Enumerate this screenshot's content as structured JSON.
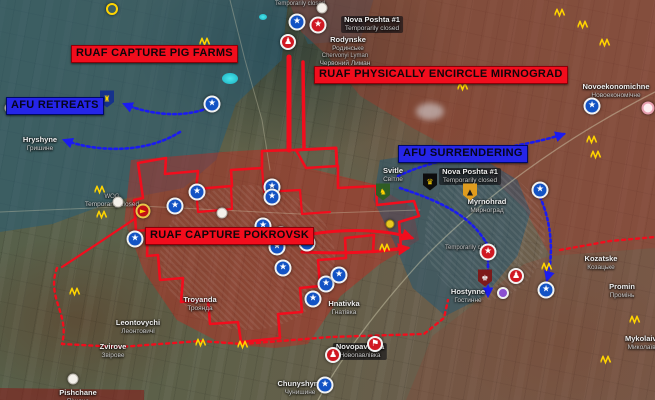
{
  "map": {
    "colors": {
      "ruaf_banner": "#f20d1d",
      "afu_banner": "#2525e8",
      "front_line_red": "#f20d1d",
      "afu_arrow_blue": "#1b1bf0",
      "fortification_yellow": "#ffd400"
    },
    "banners": [
      {
        "id": "pig-farms",
        "text": "RUAF CAPTURE PIG FARMS",
        "type": "ruaf",
        "x": 71,
        "y": 45
      },
      {
        "id": "encircle-mirnograd",
        "text": "RUAF PHYSICALLY ENCIRCLE MIRNOGRAD",
        "type": "ruaf",
        "x": 314,
        "y": 66
      },
      {
        "id": "capture-pokrovsk",
        "text": "RUAF CAPTURE POKROVSK",
        "type": "ruaf",
        "x": 145,
        "y": 227
      },
      {
        "id": "afu-retreats",
        "text": "AFU RETREATS",
        "type": "afu",
        "x": 6,
        "y": 97
      },
      {
        "id": "afu-surrendering",
        "text": "AFU SURRENDERING",
        "type": "afu",
        "x": 398,
        "y": 145
      }
    ],
    "towns": [
      {
        "name": "Hryshyne",
        "sub": "Гришине",
        "x": 40,
        "y": 136
      },
      {
        "name": "Rodynske",
        "sub": "Родинське",
        "x": 348,
        "y": 36
      },
      {
        "name": "Nova Poshta #1",
        "sub": "Temporarily closed",
        "x": 372,
        "y": 16,
        "variant": "chip"
      },
      {
        "name": "Temporarily closed",
        "x": 300,
        "y": 1,
        "variant": "tiny"
      },
      {
        "name": "Chervonyi Lyman",
        "sub": "Червоний Лиман",
        "x": 345,
        "y": 53,
        "variant": "tiny"
      },
      {
        "name": "Novoekonomichne",
        "sub": "Новоекономічне",
        "x": 616,
        "y": 83
      },
      {
        "name": "Svitle",
        "sub": "Світле",
        "x": 393,
        "y": 167
      },
      {
        "name": "Myrnohrad",
        "sub": "Мирноград",
        "x": 487,
        "y": 198
      },
      {
        "name": "Nova Poshta #1",
        "sub": "Temporarily closed",
        "x": 470,
        "y": 168,
        "variant": "chip"
      },
      {
        "name": "Hnativka",
        "sub": "Гнатівка",
        "x": 344,
        "y": 300
      },
      {
        "name": "Temporarily closed",
        "x": 470,
        "y": 245,
        "variant": "tiny"
      },
      {
        "name": "Hostynne",
        "sub": "Гостинне",
        "x": 468,
        "y": 288
      },
      {
        "name": "Troyanda",
        "sub": "Троянда",
        "x": 200,
        "y": 296
      },
      {
        "name": "Leontovychi",
        "sub": "Леонтовичі",
        "x": 138,
        "y": 319
      },
      {
        "name": "Zvirove",
        "sub": "Звірове",
        "x": 113,
        "y": 343
      },
      {
        "name": "Pishchane",
        "sub": "Піщане",
        "x": 78,
        "y": 389
      },
      {
        "name": "Kozatske",
        "sub": "Козацьке",
        "x": 601,
        "y": 255
      },
      {
        "name": "Promin",
        "sub": "Промінь",
        "x": 622,
        "y": 283
      },
      {
        "name": "Mykolaivka",
        "sub": "Миколаївка",
        "x": 645,
        "y": 335
      },
      {
        "name": "Novopavlivka",
        "sub": "Новопавлівка",
        "x": 360,
        "y": 343,
        "variant": "chip"
      },
      {
        "name": "Chunyshyne",
        "sub": "Чунишине",
        "x": 300,
        "y": 380
      },
      {
        "name": "WOG",
        "sub": "Temporarily closed",
        "x": 112,
        "y": 194,
        "variant": "tiny"
      }
    ],
    "marker_styles": {
      "star-blue": {
        "w": 17,
        "glyph": "★",
        "bg": "#1353c4",
        "fg": "#ffffff",
        "bd": "2px solid #f2f2f2",
        "fs": 9
      },
      "star-red": {
        "w": 17,
        "glyph": "★",
        "bg": "#d01822",
        "fg": "#ffffff",
        "bd": "2px solid #f2f2f2",
        "fs": 9
      },
      "walk-red": {
        "w": 16,
        "glyph": "♟",
        "bg": "#d01822",
        "fg": "#ffffff",
        "bd": "2px solid #f2f2f2",
        "fs": 9
      },
      "flag-red": {
        "w": 16,
        "glyph": "⚑",
        "bg": "#d01822",
        "fg": "#ffffff",
        "bd": "2px solid #f2f2f2",
        "fs": 9
      },
      "hand-red": {
        "w": 15,
        "glyph": "►",
        "bg": "#c01015",
        "fg": "#ffd400",
        "bd": "2px solid #e8c84a",
        "fs": 8
      },
      "closed-white": {
        "w": 11,
        "glyph": "",
        "bg": "#f3f0ea",
        "fg": "#999999",
        "bd": "1px solid #b9b4ac",
        "fs": 6
      },
      "pink-ring": {
        "w": 13,
        "glyph": "",
        "bg": "#fdeef0",
        "fg": "#d06070",
        "bd": "2px solid #e8a0b0",
        "fs": 6
      },
      "purple": {
        "w": 12,
        "glyph": "",
        "bg": "#8a4fd0",
        "fg": "#ffffff",
        "bd": "2px solid #f0f0f0",
        "fs": 6
      },
      "dot-yellow": {
        "w": 9,
        "glyph": "",
        "bg": "#e8c821",
        "fg": "#000000",
        "bd": "1px solid #9a8410",
        "fs": 6
      },
      "ring-yellow": {
        "w": 12,
        "glyph": "",
        "bg": "transparent",
        "fg": "#ffd400",
        "bd": "2px solid #ffd400",
        "fs": 6
      },
      "shield": {
        "w": 14,
        "h": 17,
        "fs": 8,
        "shape": "shield"
      },
      "trench": {
        "w": 11,
        "h": 9,
        "path": "M0,7 L2.5,1 L5,7 L7.5,1 L10,7",
        "stroke": "#ffd400"
      }
    },
    "markers": [
      {
        "type": "star-blue",
        "x": 212,
        "y": 104
      },
      {
        "type": "star-blue",
        "x": 297,
        "y": 22
      },
      {
        "type": "star-blue",
        "x": 135,
        "y": 239
      },
      {
        "type": "star-blue",
        "x": 175,
        "y": 206
      },
      {
        "type": "star-blue",
        "x": 197,
        "y": 192
      },
      {
        "type": "star-blue",
        "x": 263,
        "y": 226
      },
      {
        "type": "star-blue",
        "x": 281,
        "y": 235
      },
      {
        "type": "star-blue",
        "x": 307,
        "y": 243
      },
      {
        "type": "star-blue",
        "x": 277,
        "y": 247
      },
      {
        "type": "star-blue",
        "x": 272,
        "y": 187
      },
      {
        "type": "star-blue",
        "x": 272,
        "y": 197
      },
      {
        "type": "star-blue",
        "x": 283,
        "y": 268
      },
      {
        "type": "star-blue",
        "x": 313,
        "y": 299
      },
      {
        "type": "star-blue",
        "x": 326,
        "y": 284
      },
      {
        "type": "star-blue",
        "x": 339,
        "y": 275
      },
      {
        "type": "star-blue",
        "x": 592,
        "y": 106
      },
      {
        "type": "star-blue",
        "x": 546,
        "y": 290
      },
      {
        "type": "star-blue",
        "x": 540,
        "y": 190
      },
      {
        "type": "star-blue",
        "x": 325,
        "y": 385
      },
      {
        "type": "star-red",
        "x": 318,
        "y": 25
      },
      {
        "type": "star-red",
        "x": 488,
        "y": 252
      },
      {
        "type": "walk-red",
        "x": 288,
        "y": 42
      },
      {
        "type": "walk-red",
        "x": 333,
        "y": 355
      },
      {
        "type": "walk-red",
        "x": 516,
        "y": 276
      },
      {
        "type": "flag-red",
        "x": 375,
        "y": 344
      },
      {
        "type": "hand-red",
        "x": 143,
        "y": 211
      },
      {
        "type": "closed-white",
        "x": 118,
        "y": 202
      },
      {
        "type": "closed-white",
        "x": 322,
        "y": 8
      },
      {
        "type": "closed-white",
        "x": 222,
        "y": 213
      },
      {
        "type": "closed-white",
        "x": 73,
        "y": 379
      },
      {
        "type": "closed-white",
        "x": 10,
        "y": 108
      },
      {
        "type": "pink-ring",
        "x": 648,
        "y": 108
      },
      {
        "type": "purple",
        "x": 503,
        "y": 293
      },
      {
        "type": "dot-yellow",
        "x": 390,
        "y": 224
      },
      {
        "type": "ring-yellow",
        "x": 112,
        "y": 9
      },
      {
        "type": "shield",
        "x": 107,
        "y": 99,
        "bg": "#16328c",
        "glyph": "♜",
        "fg": "#ffd400"
      },
      {
        "type": "shield",
        "x": 430,
        "y": 182,
        "bg": "#0d0d0d",
        "glyph": "♛",
        "fg": "#ffd400"
      },
      {
        "type": "shield",
        "x": 470,
        "y": 192,
        "bg": "#e09c1e",
        "glyph": "▲",
        "fg": "#1a1a1a"
      },
      {
        "type": "shield",
        "x": 383,
        "y": 192,
        "bg": "#2f5d24",
        "glyph": "♞",
        "fg": "#ffd400"
      },
      {
        "type": "shield",
        "x": 485,
        "y": 278,
        "bg": "#7d1a1a",
        "glyph": "♚",
        "fg": "#eeeeee"
      },
      {
        "type": "trench",
        "x": 560,
        "y": 13
      },
      {
        "type": "trench",
        "x": 583,
        "y": 25
      },
      {
        "type": "trench",
        "x": 605,
        "y": 43
      },
      {
        "type": "trench",
        "x": 463,
        "y": 87
      },
      {
        "type": "trench",
        "x": 205,
        "y": 42
      },
      {
        "type": "trench",
        "x": 592,
        "y": 140
      },
      {
        "type": "trench",
        "x": 596,
        "y": 155
      },
      {
        "type": "trench",
        "x": 100,
        "y": 190
      },
      {
        "type": "trench",
        "x": 102,
        "y": 215
      },
      {
        "type": "trench",
        "x": 75,
        "y": 292
      },
      {
        "type": "trench",
        "x": 201,
        "y": 343
      },
      {
        "type": "trench",
        "x": 243,
        "y": 345
      },
      {
        "type": "trench",
        "x": 385,
        "y": 248
      },
      {
        "type": "trench",
        "x": 635,
        "y": 320
      },
      {
        "type": "trench",
        "x": 606,
        "y": 360
      },
      {
        "type": "trench",
        "x": 547,
        "y": 267
      }
    ],
    "lines": [
      {
        "d": "M655,92 C 560,140 480,200 420,262 C 372,315 340,360 318,400",
        "c": "#d8d2b4",
        "w": 1.3,
        "o": 0.45
      },
      {
        "d": "M0,212 L140,206 L300,214 L420,210",
        "c": "#d8d2b4",
        "w": 1,
        "o": 0.35
      },
      {
        "d": "M230,0 L245,60 L262,120 L270,170",
        "c": "#d8d2b4",
        "w": 1,
        "o": 0.35
      },
      {
        "d": "M289,57 L289,150",
        "c": "#f20d1d",
        "w": 5
      },
      {
        "d": "M303,62 L304,148",
        "c": "#f20d1d",
        "w": 3.5
      },
      {
        "d": "M296,150 L336,148 L337,166",
        "c": "#f20d1d",
        "w": 3
      },
      {
        "d": "M138,163 L166,158 L165,174 L198,171 L196,189 L232,186 L231,170 L262,168 L262,151 L296,150 L306,168 L338,166 L338,188 L376,186 L377,205 L414,201 L419,216 L399,222 L401,248 L373,252 L374,235 L345,238 L346,258 L318,260 L320,286 L300,288 L302,312 L278,314 L280,338 L241,342 L238,322 L210,324 L208,300 L181,302 L183,278 L160,280 L158,255 L147,256 L148,230 L136,231 L134,200 L143,198 L138,163",
        "c": "#f20d1d",
        "w": 2.6
      },
      {
        "d": "M196,189 L198,212 L232,209 L231,186",
        "c": "#f20d1d",
        "w": 2.2
      },
      {
        "d": "M262,168 L264,192 L300,190 L302,214 L330,212",
        "c": "#f20d1d",
        "w": 2.2
      },
      {
        "d": "M136,218 L100,242 L62,267",
        "c": "#f20d1d",
        "w": 2.2
      },
      {
        "d": "M312,234 C 350,228 388,230 412,238",
        "c": "#f20d1d",
        "w": 3,
        "arrow": "red"
      },
      {
        "d": "M302,252 C 340,254 378,252 408,248",
        "c": "#f20d1d",
        "w": 3,
        "arrow": "red"
      },
      {
        "d": "M57,268 C 46,298 70,314 62,344 L120,347 L200,341 L243,344 L330,337 L424,334 L444,318 L448,300",
        "c": "#f20d1d",
        "w": 2.4,
        "dash": "3 4"
      },
      {
        "d": "M560,250 L610,241 L655,237",
        "c": "#f20d1d",
        "w": 2.4,
        "dash": "3 4"
      },
      {
        "d": "M208,108 C 178,120 143,112 124,104",
        "c": "#1b1bf0",
        "w": 2.6,
        "dash": "2.5 3",
        "arrow": "blue"
      },
      {
        "d": "M180,132 C 145,154 96,152 64,140",
        "c": "#1b1bf0",
        "w": 2.6,
        "dash": "2.5 3",
        "arrow": "blue"
      },
      {
        "d": "M398,176 C 450,152 515,150 564,134",
        "c": "#1b1bf0",
        "w": 2.6,
        "dash": "2.5 3",
        "arrow": "blue"
      },
      {
        "d": "M400,188 C 442,202 472,216 488,246 L488,296",
        "c": "#1b1bf0",
        "w": 2.6,
        "dash": "2.5 3",
        "arrow": "blue"
      },
      {
        "d": "M540,197 C 553,226 553,258 547,280",
        "c": "#1b1bf0",
        "w": 2.6,
        "dash": "2.5 3",
        "arrow": "blue"
      }
    ]
  }
}
